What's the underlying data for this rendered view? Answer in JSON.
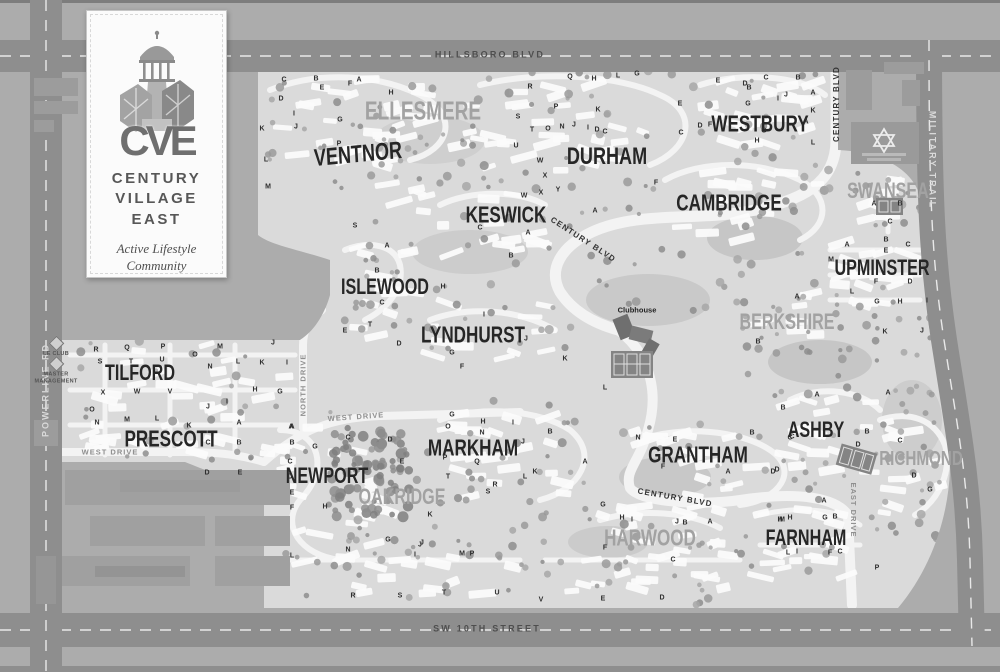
{
  "map_title": "Century Village East community map",
  "colors": {
    "outside": "#acacac",
    "interior": "#dadada",
    "main_road": "#8e8e8e",
    "inner_road": "#f3f3f3",
    "building": "#fbfbfb",
    "label_dark": "#262626",
    "label_light": "#a2a2a2",
    "temple": "#9a9a9a"
  },
  "logo_card": {
    "monogram": "CVE",
    "name_line1": "CENTURY",
    "name_line2": "VILLAGE",
    "name_line3": "EAST",
    "tagline_line1": "Active Lifestyle",
    "tagline_line2": "Community"
  },
  "neighborhoods": [
    {
      "label": "ELLESMERE",
      "x": 423,
      "y": 112,
      "tone": "light",
      "size": 20
    },
    {
      "label": "VENTNOR",
      "x": 358,
      "y": 155,
      "tone": "dark",
      "size": 19,
      "rot": -4
    },
    {
      "label": "DURHAM",
      "x": 607,
      "y": 157,
      "tone": "dark",
      "size": 19
    },
    {
      "label": "WESTBURY",
      "x": 760,
      "y": 124,
      "tone": "dark",
      "size": 18
    },
    {
      "label": "CAMBRIDGE",
      "x": 729,
      "y": 203,
      "tone": "dark",
      "size": 18
    },
    {
      "label": "KESWICK",
      "x": 506,
      "y": 215,
      "tone": "dark",
      "size": 18
    },
    {
      "label": "SWANSEA",
      "x": 888,
      "y": 191,
      "tone": "light",
      "size": 17
    },
    {
      "label": "UPMINSTER",
      "x": 882,
      "y": 268,
      "tone": "dark",
      "size": 17
    },
    {
      "label": "ISLEWOOD",
      "x": 385,
      "y": 287,
      "tone": "dark",
      "size": 17
    },
    {
      "label": "BERKSHIRE",
      "x": 787,
      "y": 322,
      "tone": "light",
      "size": 17
    },
    {
      "label": "LYNDHURST",
      "x": 473,
      "y": 335,
      "tone": "dark",
      "size": 18
    },
    {
      "label": "TILFORD",
      "x": 140,
      "y": 373,
      "tone": "dark",
      "size": 17
    },
    {
      "label": "PRESCOTT",
      "x": 171,
      "y": 439,
      "tone": "dark",
      "size": 18
    },
    {
      "label": "NEWPORT",
      "x": 327,
      "y": 476,
      "tone": "dark",
      "size": 17
    },
    {
      "label": "OAKRIDGE",
      "x": 402,
      "y": 497,
      "tone": "light",
      "size": 17
    },
    {
      "label": "MARKHAM",
      "x": 473,
      "y": 448,
      "tone": "dark",
      "size": 18
    },
    {
      "label": "GRANTHAM",
      "x": 698,
      "y": 455,
      "tone": "dark",
      "size": 18
    },
    {
      "label": "ASHBY",
      "x": 816,
      "y": 430,
      "tone": "dark",
      "size": 17
    },
    {
      "label": "RICHMOND",
      "x": 921,
      "y": 460,
      "tone": "light",
      "size": 16
    },
    {
      "label": "HARWOOD",
      "x": 650,
      "y": 538,
      "tone": "light",
      "size": 18
    },
    {
      "label": "FARNHAM",
      "x": 806,
      "y": 538,
      "tone": "dark",
      "size": 17
    }
  ],
  "road_labels": [
    {
      "label": "HILLSBORO BLVD",
      "x": 490,
      "y": 55,
      "rot": 0,
      "kind": "highway-dark"
    },
    {
      "label": "SW 10TH STREET",
      "x": 487,
      "y": 629,
      "rot": 0,
      "kind": "highway-dark"
    },
    {
      "label": "POWERLINE RD",
      "x": 46,
      "y": 390,
      "rot": -90,
      "kind": "highway-light"
    },
    {
      "label": "MILITARY TRAIL",
      "x": 932,
      "y": 160,
      "rot": 90,
      "kind": "highway-light"
    },
    {
      "label": "CENTURY BLVD",
      "x": 837,
      "y": 104,
      "rot": -90,
      "kind": "internal"
    },
    {
      "label": "CENTURY BLVD",
      "x": 583,
      "y": 240,
      "rot": 33,
      "kind": "internal"
    },
    {
      "label": "CENTURY BLVD",
      "x": 675,
      "y": 498,
      "rot": 10,
      "kind": "internal"
    },
    {
      "label": "WEST DRIVE",
      "x": 110,
      "y": 452,
      "rot": 0,
      "kind": "drive"
    },
    {
      "label": "WEST DRIVE",
      "x": 356,
      "y": 417,
      "rot": -4,
      "kind": "drive"
    },
    {
      "label": "NORTH DRIVE",
      "x": 303,
      "y": 385,
      "rot": -90,
      "kind": "drive"
    },
    {
      "label": "EAST DRIVE",
      "x": 853,
      "y": 510,
      "rot": 90,
      "kind": "drive"
    }
  ],
  "pois": [
    {
      "label": "Clubhouse",
      "x": 637,
      "y": 310,
      "kind": "poi"
    },
    {
      "label": "LE CLUB",
      "x": 56,
      "y": 348,
      "kind": "amenity"
    },
    {
      "label": "MASTER MANAGEMENT",
      "x": 56,
      "y": 372,
      "kind": "amenity"
    }
  ],
  "unit_letters": [
    [
      "C",
      284,
      80
    ],
    [
      "B",
      316,
      79
    ],
    [
      "F",
      350,
      84
    ],
    [
      "A",
      359,
      80
    ],
    [
      "E",
      322,
      88
    ],
    [
      "D",
      281,
      99
    ],
    [
      "H",
      391,
      93
    ],
    [
      "I",
      294,
      114
    ],
    [
      "G",
      340,
      120
    ],
    [
      "J",
      296,
      127
    ],
    [
      "K",
      262,
      129
    ],
    [
      "L",
      266,
      160
    ],
    [
      "M",
      268,
      187
    ],
    [
      "P",
      339,
      144
    ],
    [
      "R",
      530,
      87
    ],
    [
      "Q",
      570,
      77
    ],
    [
      "H",
      594,
      79
    ],
    [
      "L",
      618,
      76
    ],
    [
      "G",
      637,
      74
    ],
    [
      "P",
      556,
      107
    ],
    [
      "K",
      598,
      110
    ],
    [
      "S",
      518,
      117
    ],
    [
      "T",
      532,
      130
    ],
    [
      "O",
      548,
      129
    ],
    [
      "N",
      562,
      127
    ],
    [
      "J",
      574,
      125
    ],
    [
      "I",
      588,
      128
    ],
    [
      "D",
      597,
      130
    ],
    [
      "C",
      605,
      132
    ],
    [
      "U",
      516,
      146
    ],
    [
      "W",
      540,
      161
    ],
    [
      "X",
      545,
      176
    ],
    [
      "Y",
      558,
      190
    ],
    [
      "E",
      718,
      81
    ],
    [
      "D",
      745,
      84
    ],
    [
      "C",
      766,
      78
    ],
    [
      "B",
      798,
      78
    ],
    [
      "J",
      786,
      95
    ],
    [
      "A",
      813,
      93
    ],
    [
      "I",
      778,
      99
    ],
    [
      "G",
      748,
      104
    ],
    [
      "K",
      813,
      111
    ],
    [
      "F",
      710,
      125
    ],
    [
      "H",
      757,
      141
    ],
    [
      "L",
      813,
      143
    ],
    [
      "F",
      656,
      183
    ],
    [
      "E",
      680,
      104
    ],
    [
      "C",
      681,
      133
    ],
    [
      "B",
      749,
      88
    ],
    [
      "G",
      764,
      131
    ],
    [
      "A",
      806,
      122
    ],
    [
      "D",
      700,
      126
    ],
    [
      "A",
      874,
      204
    ],
    [
      "B",
      900,
      204
    ],
    [
      "C",
      890,
      222
    ],
    [
      "A",
      847,
      245
    ],
    [
      "B",
      886,
      240
    ],
    [
      "C",
      908,
      245
    ],
    [
      "E",
      886,
      251
    ],
    [
      "M",
      831,
      260
    ],
    [
      "F",
      876,
      282
    ],
    [
      "D",
      910,
      282
    ],
    [
      "L",
      852,
      292
    ],
    [
      "G",
      877,
      302
    ],
    [
      "H",
      900,
      302
    ],
    [
      "I",
      927,
      301
    ],
    [
      "K",
      885,
      332
    ],
    [
      "J",
      922,
      331
    ],
    [
      "C",
      480,
      228
    ],
    [
      "A",
      528,
      233
    ],
    [
      "B",
      511,
      256
    ],
    [
      "X",
      541,
      193
    ],
    [
      "W",
      524,
      196
    ],
    [
      "A",
      595,
      211
    ],
    [
      "S",
      355,
      226
    ],
    [
      "A",
      387,
      246
    ],
    [
      "B",
      377,
      271
    ],
    [
      "C",
      382,
      303
    ],
    [
      "T",
      370,
      325
    ],
    [
      "D",
      399,
      344
    ],
    [
      "E",
      345,
      331
    ],
    [
      "H",
      443,
      287
    ],
    [
      "I",
      484,
      315
    ],
    [
      "J",
      526,
      339
    ],
    [
      "G",
      452,
      353
    ],
    [
      "F",
      462,
      367
    ],
    [
      "K",
      565,
      359
    ],
    [
      "L",
      605,
      388
    ],
    [
      "A",
      797,
      297
    ],
    [
      "B",
      758,
      342
    ],
    [
      "A",
      817,
      395
    ],
    [
      "B",
      783,
      408
    ],
    [
      "C",
      792,
      437
    ],
    [
      "D",
      858,
      445
    ],
    [
      "B",
      867,
      432
    ],
    [
      "D",
      777,
      470
    ],
    [
      "A",
      888,
      393
    ],
    [
      "C",
      900,
      441
    ],
    [
      "D",
      914,
      476
    ],
    [
      "G",
      930,
      490
    ],
    [
      "N",
      638,
      438
    ],
    [
      "E",
      675,
      440
    ],
    [
      "F",
      663,
      467
    ],
    [
      "A",
      728,
      472
    ],
    [
      "D",
      773,
      472
    ],
    [
      "C",
      790,
      438
    ],
    [
      "B",
      752,
      433
    ],
    [
      "M",
      782,
      520
    ],
    [
      "H",
      790,
      518
    ],
    [
      "G",
      452,
      415
    ],
    [
      "H",
      483,
      422
    ],
    [
      "O",
      448,
      427
    ],
    [
      "N",
      482,
      433
    ],
    [
      "I",
      513,
      423
    ],
    [
      "J",
      523,
      442
    ],
    [
      "P",
      445,
      458
    ],
    [
      "Q",
      477,
      462
    ],
    [
      "K",
      535,
      472
    ],
    [
      "T",
      448,
      477
    ],
    [
      "L",
      525,
      477
    ],
    [
      "R",
      495,
      485
    ],
    [
      "S",
      488,
      492
    ],
    [
      "B",
      550,
      432
    ],
    [
      "A",
      585,
      462
    ],
    [
      "A",
      292,
      427
    ],
    [
      "B",
      292,
      443
    ],
    [
      "G",
      315,
      447
    ],
    [
      "C",
      290,
      462
    ],
    [
      "D",
      290,
      477
    ],
    [
      "E",
      292,
      493
    ],
    [
      "F",
      292,
      508
    ],
    [
      "H",
      325,
      507
    ],
    [
      "N",
      348,
      550
    ],
    [
      "J",
      420,
      545
    ],
    [
      "I",
      415,
      555
    ],
    [
      "L",
      292,
      556
    ],
    [
      "C",
      348,
      438
    ],
    [
      "D",
      390,
      440
    ],
    [
      "E",
      402,
      462
    ],
    [
      "K",
      430,
      515
    ],
    [
      "G",
      388,
      540
    ],
    [
      "J",
      422,
      543
    ],
    [
      "M",
      462,
      554
    ],
    [
      "P",
      472,
      554
    ],
    [
      "G",
      603,
      505
    ],
    [
      "H",
      622,
      518
    ],
    [
      "I",
      632,
      520
    ],
    [
      "J",
      677,
      522
    ],
    [
      "B",
      685,
      523
    ],
    [
      "A",
      710,
      522
    ],
    [
      "F",
      605,
      548
    ],
    [
      "C",
      673,
      560
    ],
    [
      "H",
      780,
      520
    ],
    [
      "A",
      824,
      501
    ],
    [
      "G",
      825,
      518
    ],
    [
      "B",
      835,
      517
    ],
    [
      "L",
      788,
      553
    ],
    [
      "I",
      797,
      552
    ],
    [
      "F",
      830,
      553
    ],
    [
      "C",
      840,
      552
    ],
    [
      "P",
      877,
      568
    ],
    [
      "R",
      96,
      350
    ],
    [
      "Q",
      127,
      348
    ],
    [
      "P",
      163,
      347
    ],
    [
      "S",
      100,
      362
    ],
    [
      "T",
      131,
      362
    ],
    [
      "U",
      162,
      360
    ],
    [
      "O",
      195,
      355
    ],
    [
      "M",
      220,
      347
    ],
    [
      "N",
      210,
      367
    ],
    [
      "L",
      238,
      362
    ],
    [
      "K",
      262,
      363
    ],
    [
      "I",
      287,
      363
    ],
    [
      "J",
      273,
      343
    ],
    [
      "X",
      103,
      393
    ],
    [
      "W",
      137,
      392
    ],
    [
      "V",
      170,
      392
    ],
    [
      "H",
      255,
      390
    ],
    [
      "G",
      280,
      392
    ],
    [
      "O",
      92,
      410
    ],
    [
      "N",
      97,
      423
    ],
    [
      "M",
      127,
      420
    ],
    [
      "L",
      157,
      419
    ],
    [
      "K",
      189,
      426
    ],
    [
      "J",
      208,
      407
    ],
    [
      "I",
      227,
      402
    ],
    [
      "A",
      239,
      423
    ],
    [
      "B",
      239,
      443
    ],
    [
      "C",
      208,
      443
    ],
    [
      "D",
      207,
      473
    ],
    [
      "E",
      240,
      473
    ],
    [
      "A",
      291,
      427
    ],
    [
      "R",
      353,
      596
    ],
    [
      "S",
      400,
      596
    ],
    [
      "T",
      444,
      593
    ],
    [
      "U",
      497,
      593
    ],
    [
      "V",
      541,
      600
    ],
    [
      "E",
      603,
      599
    ],
    [
      "D",
      662,
      598
    ]
  ]
}
